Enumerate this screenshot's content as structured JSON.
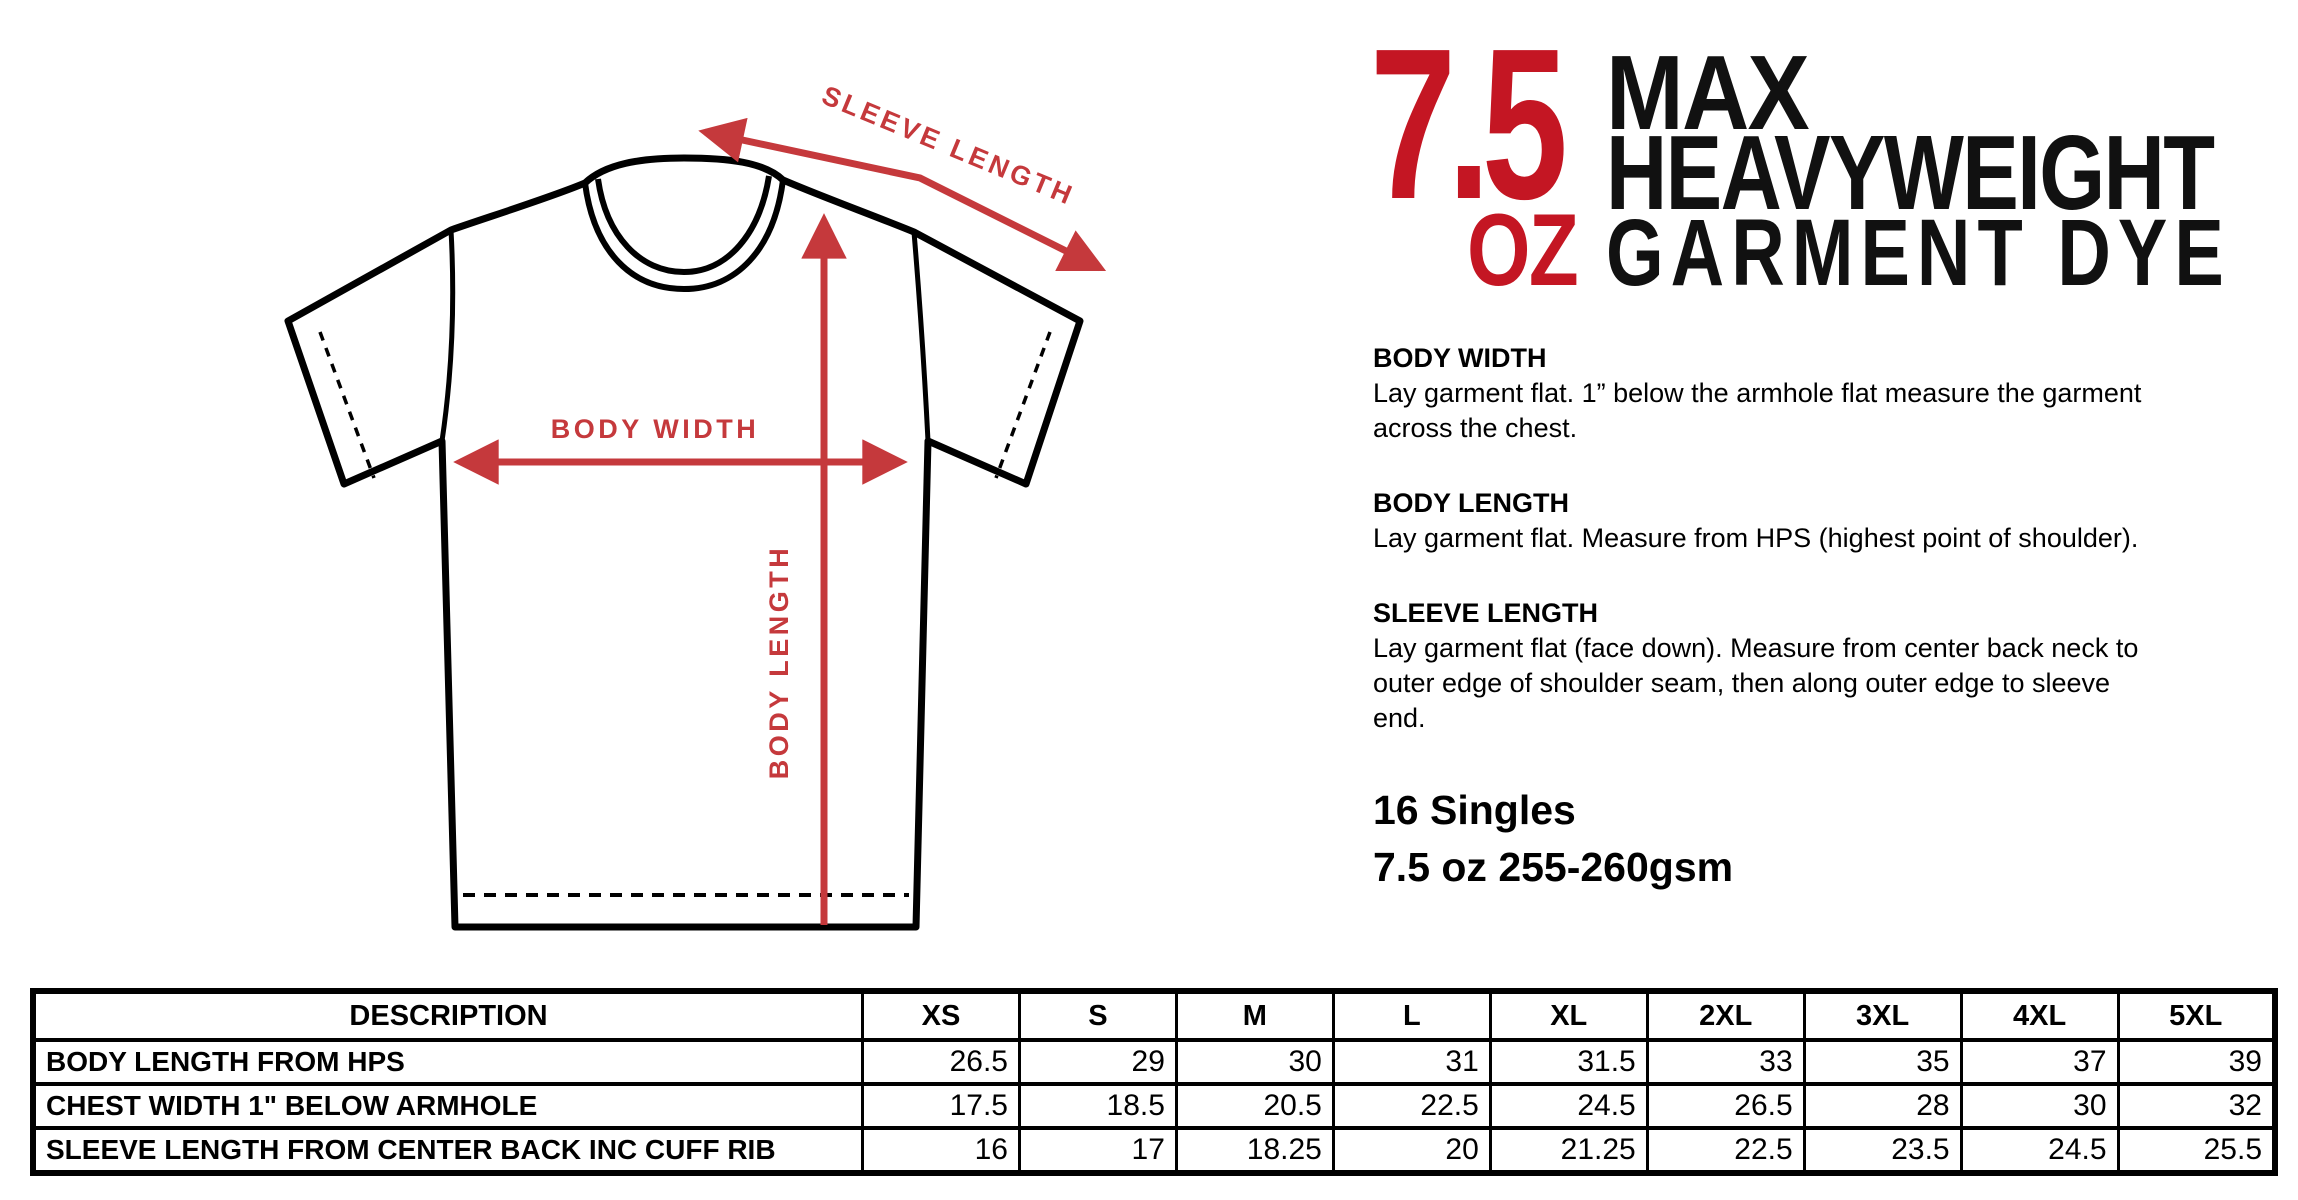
{
  "title": {
    "weight_number": "7.5",
    "weight_unit": "OZ",
    "line1": "MAX",
    "line2": "HEAVYWEIGHT",
    "line3": "GARMENT DYE",
    "number_color": "#C41623",
    "text_color": "#111111"
  },
  "diagram": {
    "labels": {
      "sleeve_length": "SLEEVE LENGTH",
      "body_width": "BODY WIDTH",
      "body_length": "BODY LENGTH"
    },
    "accent_color": "#C5393C",
    "outline_color": "#000000"
  },
  "info_sections": [
    {
      "heading": "BODY WIDTH",
      "body": "Lay garment flat. 1” below the armhole flat measure the garment across the chest."
    },
    {
      "heading": "BODY LENGTH",
      "body": "Lay garment flat. Measure from HPS (highest point of shoulder)."
    },
    {
      "heading": "SLEEVE LENGTH",
      "body": "Lay garment flat (face down). Measure from center back neck to outer edge of shoulder seam, then along outer edge to sleeve end."
    }
  ],
  "fabric_specs": [
    "16 Singles",
    "7.5 oz 255-260gsm"
  ],
  "size_table": {
    "columns": [
      "DESCRIPTION",
      "XS",
      "S",
      "M",
      "L",
      "XL",
      "2XL",
      "3XL",
      "4XL",
      "5XL"
    ],
    "rows": [
      {
        "description": "BODY LENGTH FROM HPS",
        "values": [
          "26.5",
          "29",
          "30",
          "31",
          "31.5",
          "33",
          "35",
          "37",
          "39"
        ]
      },
      {
        "description": "CHEST WIDTH 1\" BELOW ARMHOLE",
        "values": [
          "17.5",
          "18.5",
          "20.5",
          "22.5",
          "24.5",
          "26.5",
          "28",
          "30",
          "32"
        ]
      },
      {
        "description": "SLEEVE LENGTH FROM CENTER BACK INC CUFF RIB",
        "values": [
          "16",
          "17",
          "18.25",
          "20",
          "21.25",
          "22.5",
          "23.5",
          "24.5",
          "25.5"
        ]
      }
    ]
  }
}
